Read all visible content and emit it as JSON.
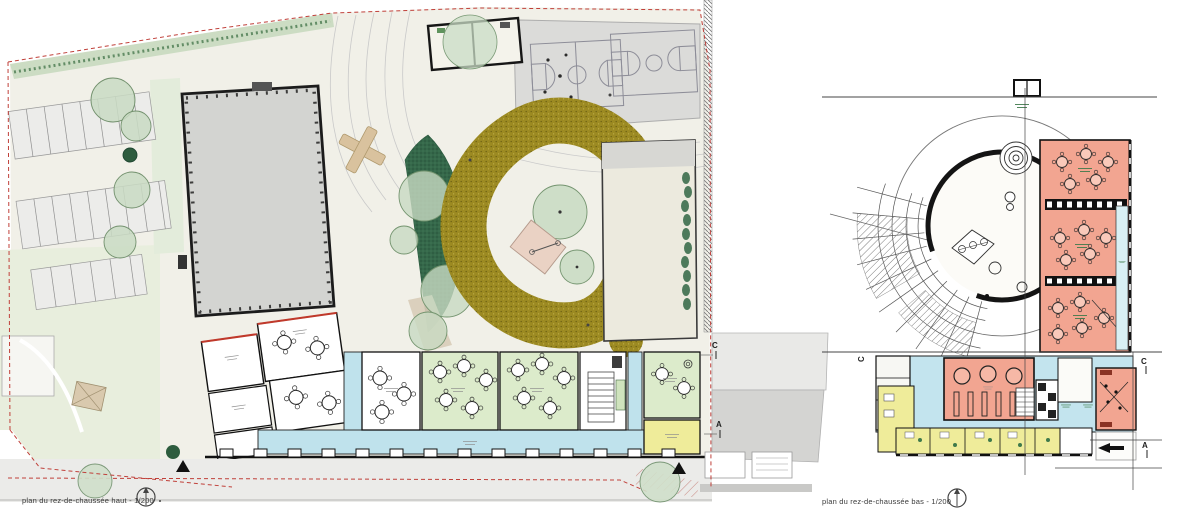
{
  "captions": {
    "left": "plan du rez-de-chaussée haut - 1/200",
    "right": "plan du rez-de-chaussée bas - 1/200"
  },
  "section_markers": {
    "left_c": "C",
    "left_a": "A",
    "right_c_side": "C",
    "right_c": "C",
    "right_a": "A"
  },
  "legend_colors": {
    "property_line_red": "#c0403a",
    "playground_path_olive": "#9c8a22",
    "activity_room_salmon": "#f2a591",
    "circulation_blue": "#bfe2ec",
    "service_room_yellow": "#efec9a",
    "classroom_green": "#dcebcb",
    "tree_canopy_green": "#c9dbc3",
    "dense_planting_green": "#35684a",
    "existing_building_gray": "#d3d4d1",
    "sports_court_gray": "#dbdbd9"
  }
}
